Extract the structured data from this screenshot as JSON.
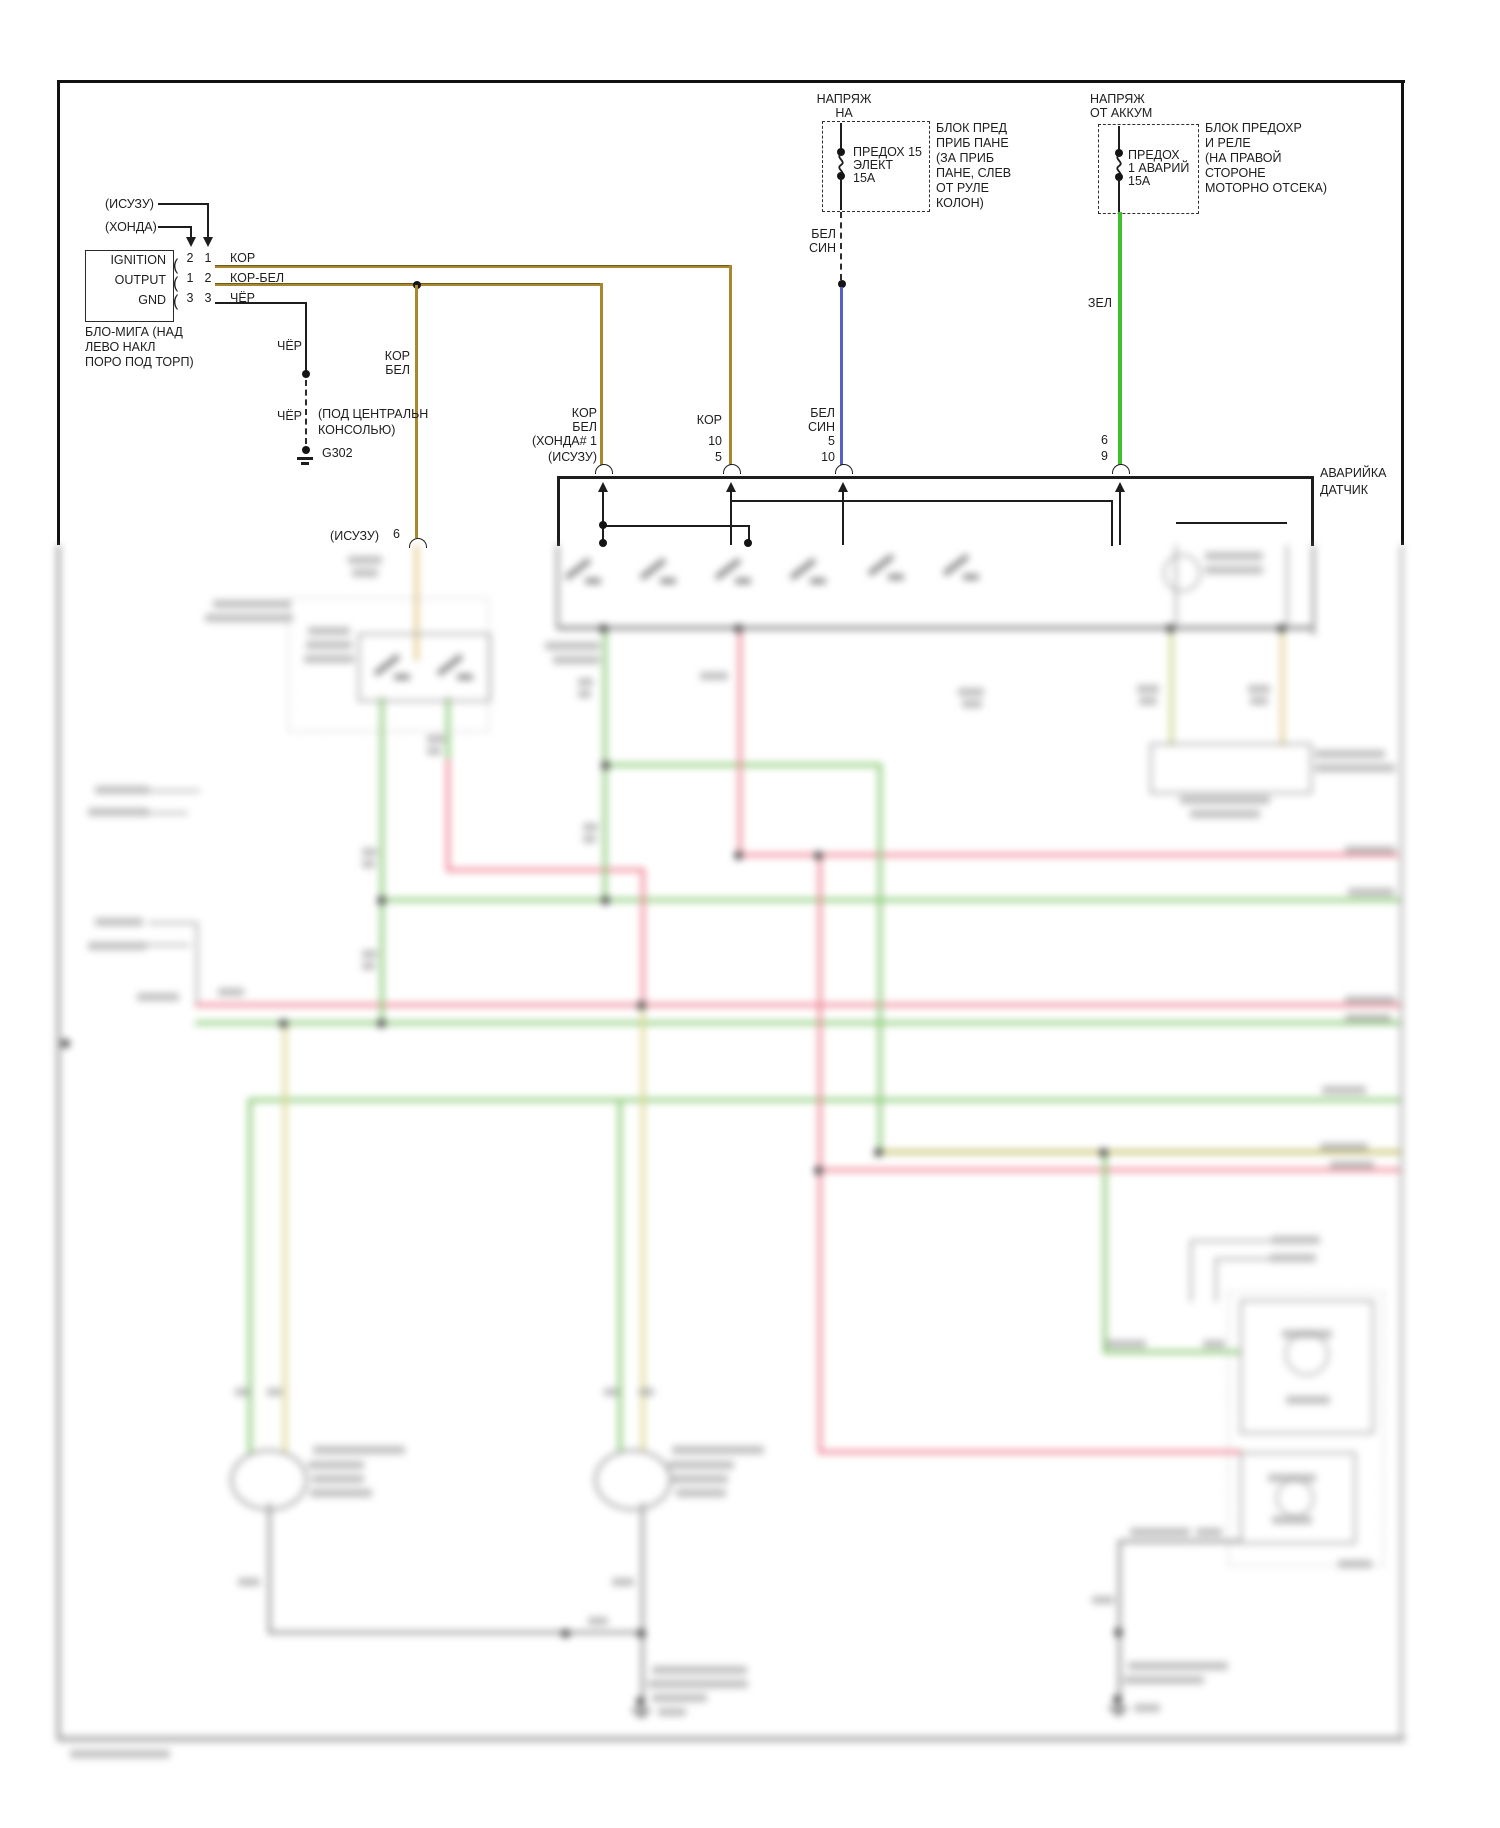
{
  "diagram": {
    "flasher": {
      "variant_top": "(ИСУЗУ)",
      "variant_bottom": "(ХОНДА)",
      "unit_labels": [
        "IGNITION",
        "OUTPUT",
        "GND"
      ],
      "pins": [
        {
          "col1": "2",
          "col2": "1",
          "wire": "КОР"
        },
        {
          "col1": "1",
          "col2": "2",
          "wire": "КОР-БЕЛ"
        },
        {
          "col1": "3",
          "col2": "3",
          "wire": "ЧЁР"
        }
      ],
      "caption": [
        "БЛО-МИГА (НАД",
        "ЛЕВО НАКЛ",
        "ПОРО ПОД ТОРП)"
      ]
    },
    "ground_path": {
      "wire_label_upper": "ЧЁР",
      "wire_label_lower": "ЧЁР",
      "location": [
        "(ПОД ЦЕНТРАЛЬН",
        "КОНСОЛЬЮ)"
      ],
      "ground_id": "G302"
    },
    "branch_wire": {
      "label": [
        "КОР",
        "БЕЛ"
      ],
      "connector": "(ИСУЗУ)",
      "pin": "6"
    },
    "fuse_panel": {
      "feed": [
        "НАПРЯЖ",
        "НА"
      ],
      "fuse": [
        "ПРЕДОХ 15",
        "ЭЛЕКТ",
        "15А"
      ],
      "location": [
        "БЛОК ПРЕД",
        "ПРИБ ПАНЕ",
        "(ЗА ПРИБ",
        "ПАНЕ, СЛЕВ",
        "ОТ РУЛЕ",
        "КОЛОН)"
      ],
      "wire": [
        "БЕЛ",
        "СИН"
      ]
    },
    "fuse_battery": {
      "feed": [
        "НАПРЯЖ",
        "ОТ АККУМ"
      ],
      "fuse": [
        "ПРЕДОХ",
        "1 АВАРИЙ",
        "15А"
      ],
      "location": [
        "БЛОК ПРЕДОХР",
        "И РЕЛЕ",
        "(НА ПРАВОЙ",
        "СТОРОНЕ",
        "МОТОРНО ОТСЕКА)"
      ],
      "wire": "ЗЕЛ"
    },
    "hazard_switch": {
      "name": [
        "АВАРИЙКА",
        "ДАТЧИК"
      ],
      "input1": [
        "КОР",
        "БЕЛ",
        "(ХОНДА# 1",
        "(ИСУЗУ)"
      ],
      "input2": [
        "КОР",
        "10",
        "5"
      ],
      "input3": [
        "БЕЛ",
        "СИН",
        "5",
        "10"
      ],
      "input4": [
        "6",
        "9"
      ]
    },
    "colors": {
      "wire_tan": "#a8872e",
      "wire_blue": "#5560c4",
      "wire_green": "#3fbe2f",
      "wire_black": "#1d1d1d"
    }
  }
}
